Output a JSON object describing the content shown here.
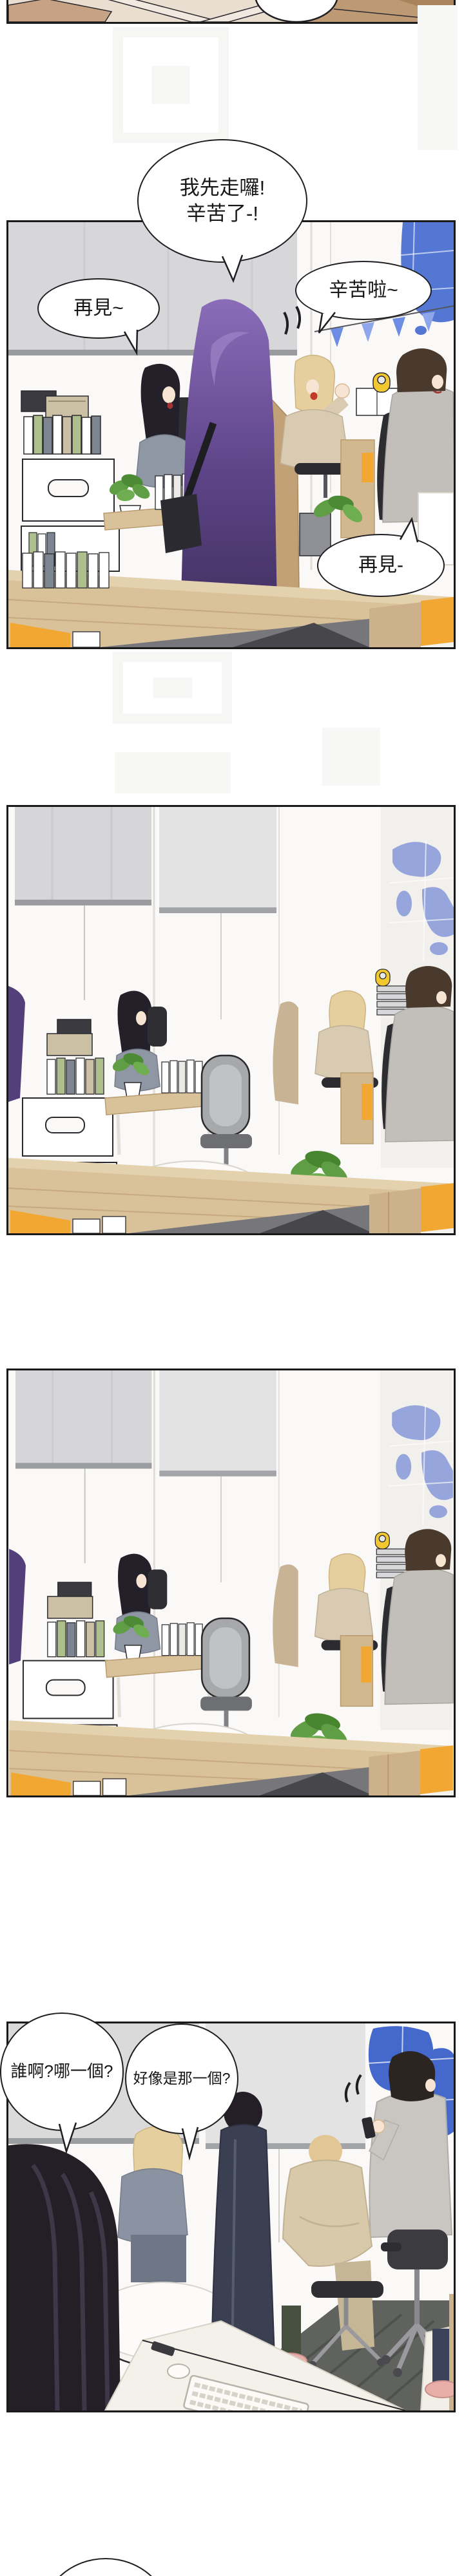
{
  "comic": {
    "bubbles": {
      "farewell_main": "我先走囉!\n辛苦了-!",
      "goodbye_left": "再見~",
      "thanks_right": "辛苦啦~",
      "goodbye_small": "再見-",
      "who_which": "誰啊?哪一個?",
      "seems_that_one": "好像是那一個?"
    },
    "panels": [
      {
        "id": "panel-top-partial",
        "bubbles": []
      },
      {
        "id": "panel-1",
        "bubbles": [
          "farewell_main",
          "goodbye_left",
          "thanks_right",
          "goodbye_small"
        ]
      },
      {
        "id": "panel-2",
        "bubbles": []
      },
      {
        "id": "panel-3",
        "bubbles": []
      },
      {
        "id": "panel-4",
        "bubbles": [
          "who_which",
          "seems_that_one"
        ]
      },
      {
        "id": "panel-next-partial",
        "bubbles": []
      }
    ],
    "colors": {
      "panel_border": "#1a1a1a",
      "accent_orange": "#f2a733",
      "map_blue_vivid": "#4a6fd2",
      "map_blue_soft": "#96a5db",
      "desk_wood": "#d9c29a",
      "carpet_gray": "#77777b",
      "carpet_dark": "#46464b",
      "shade_gray": "#d7d7d9",
      "hair_purple": "#5d4488",
      "hair_blonde": "#e6cf9f",
      "coat_camel": "#c3a176",
      "plant_green": "#5f9e44"
    }
  }
}
